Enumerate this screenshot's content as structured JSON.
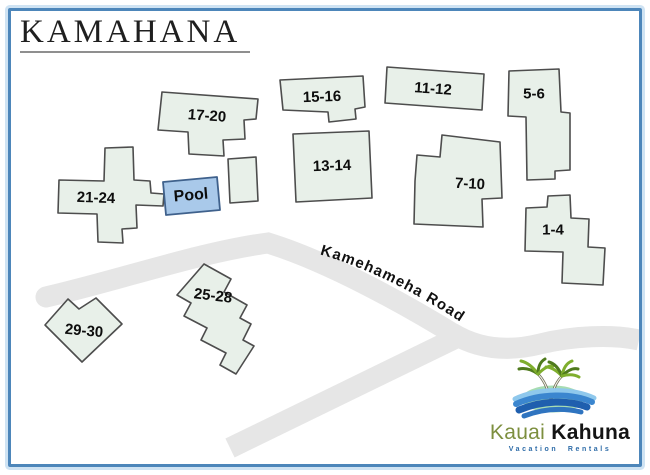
{
  "title": "KAMAHANA",
  "map": {
    "road_label": "Kamehameha Road",
    "pool_label": "Pool",
    "buildings": [
      {
        "label": "17-20"
      },
      {
        "label": "15-16"
      },
      {
        "label": "13-14"
      },
      {
        "label": "11-12"
      },
      {
        "label": "5-6"
      },
      {
        "label": "7-10"
      },
      {
        "label": "1-4"
      },
      {
        "label": "21-24"
      },
      {
        "label": "25-28"
      },
      {
        "label": "29-30"
      }
    ]
  },
  "logo": {
    "name_first": "Kauai",
    "name_second": "Kahuna",
    "tagline": "Vacation Rentals"
  },
  "colors": {
    "frame_border": "#4d86ba",
    "frame_halo": "#cfe3f3",
    "road": "#e6e6e6",
    "building_fill": "#e8f0e9",
    "building_stroke": "#4d4d4d",
    "pool_fill": "#a9c9ea",
    "pool_stroke": "#3f618c",
    "logo_green": "#7d8f3f",
    "logo_blue": "#2e6ca8",
    "island_green": "#a7dcb2"
  }
}
